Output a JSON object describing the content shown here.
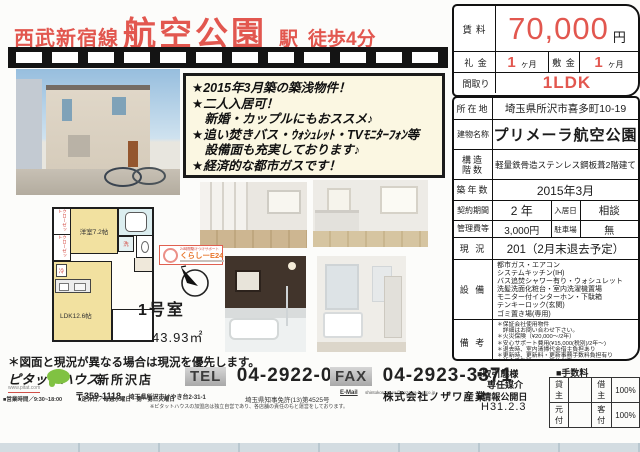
{
  "colors": {
    "accent_red": "#e2574f",
    "highlight_bg": "#fbf7e2",
    "brand_green": "#80c242",
    "badge_orange": "#e8762c"
  },
  "header": {
    "line_name": "西武新宿線",
    "station_name": "航空公園",
    "station_suffix": "駅",
    "walk_time": "徒歩4分"
  },
  "price_box": {
    "rent_label": "賃料",
    "rent_value": "70,000",
    "rent_unit": "円",
    "key_money_label": "礼 金",
    "key_money_value": "1",
    "key_money_unit": "ヶ月",
    "deposit_label": "敷 金",
    "deposit_value": "1",
    "deposit_unit": "ヶ月",
    "layout_label": "間取り",
    "layout_value": "1LDK"
  },
  "details": {
    "location_label": "所在地",
    "location": "埼玉県所沢市喜多町10-19",
    "building_label": "建物名称",
    "building": "プリメーラ航空公園",
    "structure_label_1": "構造",
    "structure_label_2": "階数",
    "structure": "軽量鉄骨造ステンレス鋼板葺2階建て",
    "age_label": "築年数",
    "age": "2015年3月",
    "term_label": "契約期間",
    "term_value": "2 年",
    "movein_label": "入居日",
    "movein_value": "相談",
    "mgmt_label": "管理費等",
    "mgmt_value": "3,000円",
    "parking_label": "駐車場",
    "parking_value": "無",
    "status_label": "現 況",
    "status_value": "201（2月末退去予定）",
    "equipment_label": "設 備",
    "equipment": [
      "都市ガス・エアコン",
      "システムキッチン(IH)",
      "バス追焚シャワー有り・ウォシュレット",
      "洗髪洗面化粧台・室内洗濯機置場",
      "モニター付インターホン・下駄箱",
      "テンキーロック(玄関)",
      "ゴミ置き場(専用)"
    ],
    "remarks_label": "備 考",
    "remarks": [
      "＊保証会社使用物件",
      "　詳細はお問い合わせ下さい。",
      "＊火災保険（¥20,000～/2年）",
      "＊安心サポート費用(¥15,000(税別)/2年～)",
      "＊退去時、室内清掃代金借主負担あり",
      "＊更新時、更新料・更新事務手数料負担有り",
      "＊仲介手数料1.08ヶ月分必要"
    ]
  },
  "highlights": {
    "lines": [
      "★2015年3月築の築浅物件！",
      "★二人入居可！",
      "　新婚・カップルにもおススメ♪",
      "★追い焚きバス・ｳｫｼｭﾚｯﾄ・TVﾓﾆﾀｰﾌｫﾝ等",
      "　設備面も充実しております♪",
      "★経済的な都市ガスです！"
    ]
  },
  "floorplan": {
    "closet1": "クローゼット",
    "closet2": "クローゼット",
    "room1": "洋室7.2帖",
    "fridge": "冷",
    "wash": "洗",
    "ldk": "LDK12.6帖",
    "room_no": "1号室",
    "area": "43.93㎡",
    "note": "＊図面と現況が異なる場合は現況を優先します。"
  },
  "support_badge": {
    "top": "24時間駆けつけサポート",
    "main": "くらしーE24"
  },
  "footer": {
    "brand": "ピタットハウス",
    "brand_url": "www.pitat.com",
    "store": "新所沢店",
    "tel_label": "TEL",
    "tel_number": "04-2922-0110",
    "fax_label": "FAX",
    "fax_number": "04-2923-3371",
    "postal_code": "〒359-1118",
    "address": "埼玉県所沢市けやき台2-31-1",
    "hours": "■営業時間／9:30~18:00",
    "holiday": "■定休日／毎週水曜日・第一第三火曜日",
    "license": "埼玉県知事免許(13)第4525号",
    "franchise_note": "※ピタットハウスの加盟店は独立自営であり、各店舗の責任のもと運営をしております。",
    "email_label": "E-Mail",
    "email": "shintokorozawa@nozawa-b-g.co.jp",
    "company": "株式会社ノザワ産業",
    "deal_type_label": "■取引態様",
    "deal_type_value": "専任媒介",
    "publish_label": "■情報公開日",
    "publish_value": "H31.2.3",
    "fee_title": "■手数料",
    "fee_rows": [
      [
        "貸主",
        "",
        "借主",
        "100%"
      ],
      [
        "元付",
        "",
        "客付",
        "100%"
      ]
    ]
  }
}
